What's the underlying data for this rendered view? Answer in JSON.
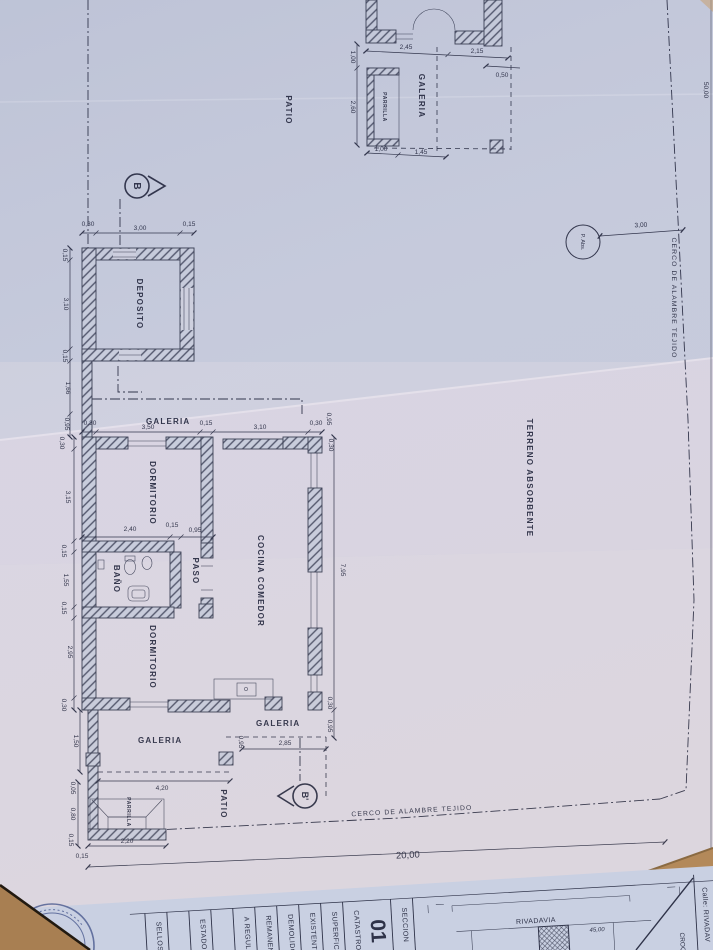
{
  "labels": {
    "patio_top": "PATIO",
    "galeria_top": "GALERIA",
    "parrilla_top": "PARRILLA",
    "deposito": "DEPOSITO",
    "galeria_main": "GALERIA",
    "dormitorio_1": "DORMITORIO",
    "banio": "BAÑO",
    "paso": "PASO",
    "dormitorio_2": "DORMITORIO",
    "cocina_comedor": "COCINA COMEDOR",
    "galeria_back_left": "GALERIA",
    "galeria_back_right": "GALERIA",
    "patio_back": "PATIO",
    "parrilla_back": "PARRILLA",
    "terreno_absorbente": "TERRENO ABSORBENTE",
    "pozo_absorbente": "P. Abs.",
    "cerco_right": "CERCO DE ALAMBRE TEJIDO",
    "cerco_bottom": "CERCO DE ALAMBRE TEJIDO",
    "section_b": "B",
    "section_b_prime": "B'"
  },
  "dimensions": {
    "top_structure": [
      "2,45",
      "2,15",
      "0,50",
      "1,00",
      "2,60",
      "1,00",
      "1,45"
    ],
    "deposito": [
      "0,30",
      "3,00",
      "0,15",
      "0,15",
      "3,10",
      "0,15",
      "1,66",
      "0,95"
    ],
    "house_top": [
      "0,30",
      "3,50",
      "0,15",
      "3,10",
      "0,30",
      "0,95",
      "0,30"
    ],
    "house_left": [
      "0,30",
      "3,15",
      "0,15",
      "1,55",
      "0,15",
      "2,95",
      "0,30"
    ],
    "house_mid": [
      "2,40",
      "0,15",
      "0,95"
    ],
    "house_right": [
      "7,95",
      "0,30",
      "0,95"
    ],
    "galeria_back": [
      "1,50",
      "0,95",
      "2,85",
      "4,20"
    ],
    "parrilla_back": [
      "0,05",
      "0,80",
      "0,15",
      "2,20",
      "0,15"
    ],
    "site": [
      "50,00",
      "20,00",
      "3,00"
    ]
  },
  "titleblock": {
    "fields": [
      "SELLOS C",
      "ESTADO E",
      "A REGULAR",
      "REMANENTE",
      "DEMOLIDO",
      "EXISTENTE",
      "SUPERFICIE",
      "CATASTRO:",
      "01",
      "SECCION"
    ],
    "croquis": {
      "street": "RIVADAVIA",
      "street_dim": "45,00",
      "calle_field": "Calle:  RIVADAV",
      "croquis_label": "CROQ"
    }
  }
}
